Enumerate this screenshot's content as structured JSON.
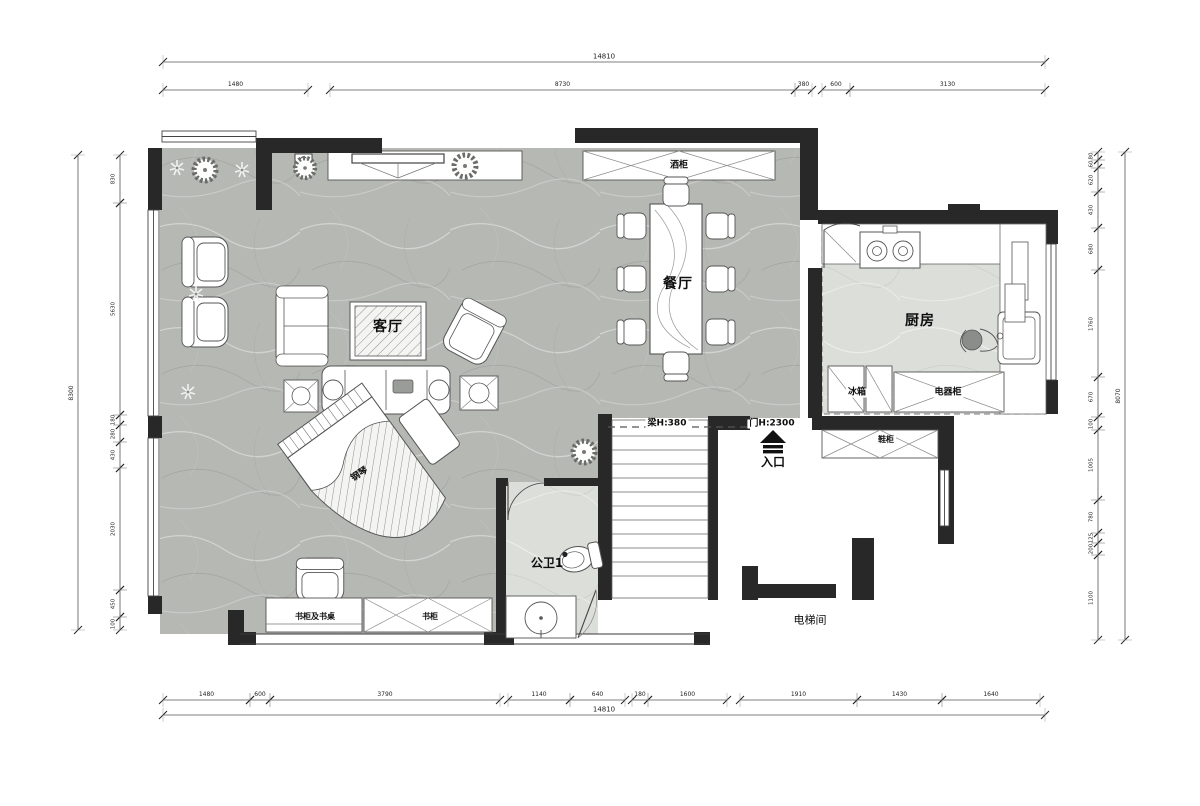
{
  "labels": {
    "living": "客厅",
    "dining": "餐厅",
    "kitchen": "厨房",
    "bath": "公卫1",
    "entry": "入口",
    "elevator": "电梯间",
    "piano": "钢琴",
    "wine_cabinet": "酒柜",
    "fridge": "冰箱",
    "appliance_cabinet": "电器柜",
    "shoe_cabinet": "鞋柜",
    "bookcase_desk": "书柜及书桌",
    "bookcase": "书柜",
    "beam": "梁H:380",
    "door_height": "门H:2300"
  },
  "dimensions": {
    "top_overall": "14810",
    "top_segments": [
      "1480",
      "8730",
      "380",
      "600",
      "3130"
    ],
    "bottom_segments": [
      "1480",
      "600",
      "3790",
      "1140",
      "640",
      "180",
      "1600",
      "1910",
      "1430",
      "1640"
    ],
    "bottom_overall": "14810",
    "left_overall": "8300",
    "left_segments": [
      "830",
      "5630",
      "180",
      "280",
      "430",
      "2030",
      "450",
      "100"
    ],
    "right_segments": [
      "80",
      "60",
      "620",
      "430",
      "680",
      "1760",
      "670",
      "100",
      "1005",
      "780",
      "125",
      "200",
      "1100"
    ],
    "right_overall": "8070"
  },
  "colors": {
    "wall": "#282828",
    "line": "#4a4a4a",
    "floor_main": "#b6b8b4",
    "floor_light": "#dcded9"
  }
}
